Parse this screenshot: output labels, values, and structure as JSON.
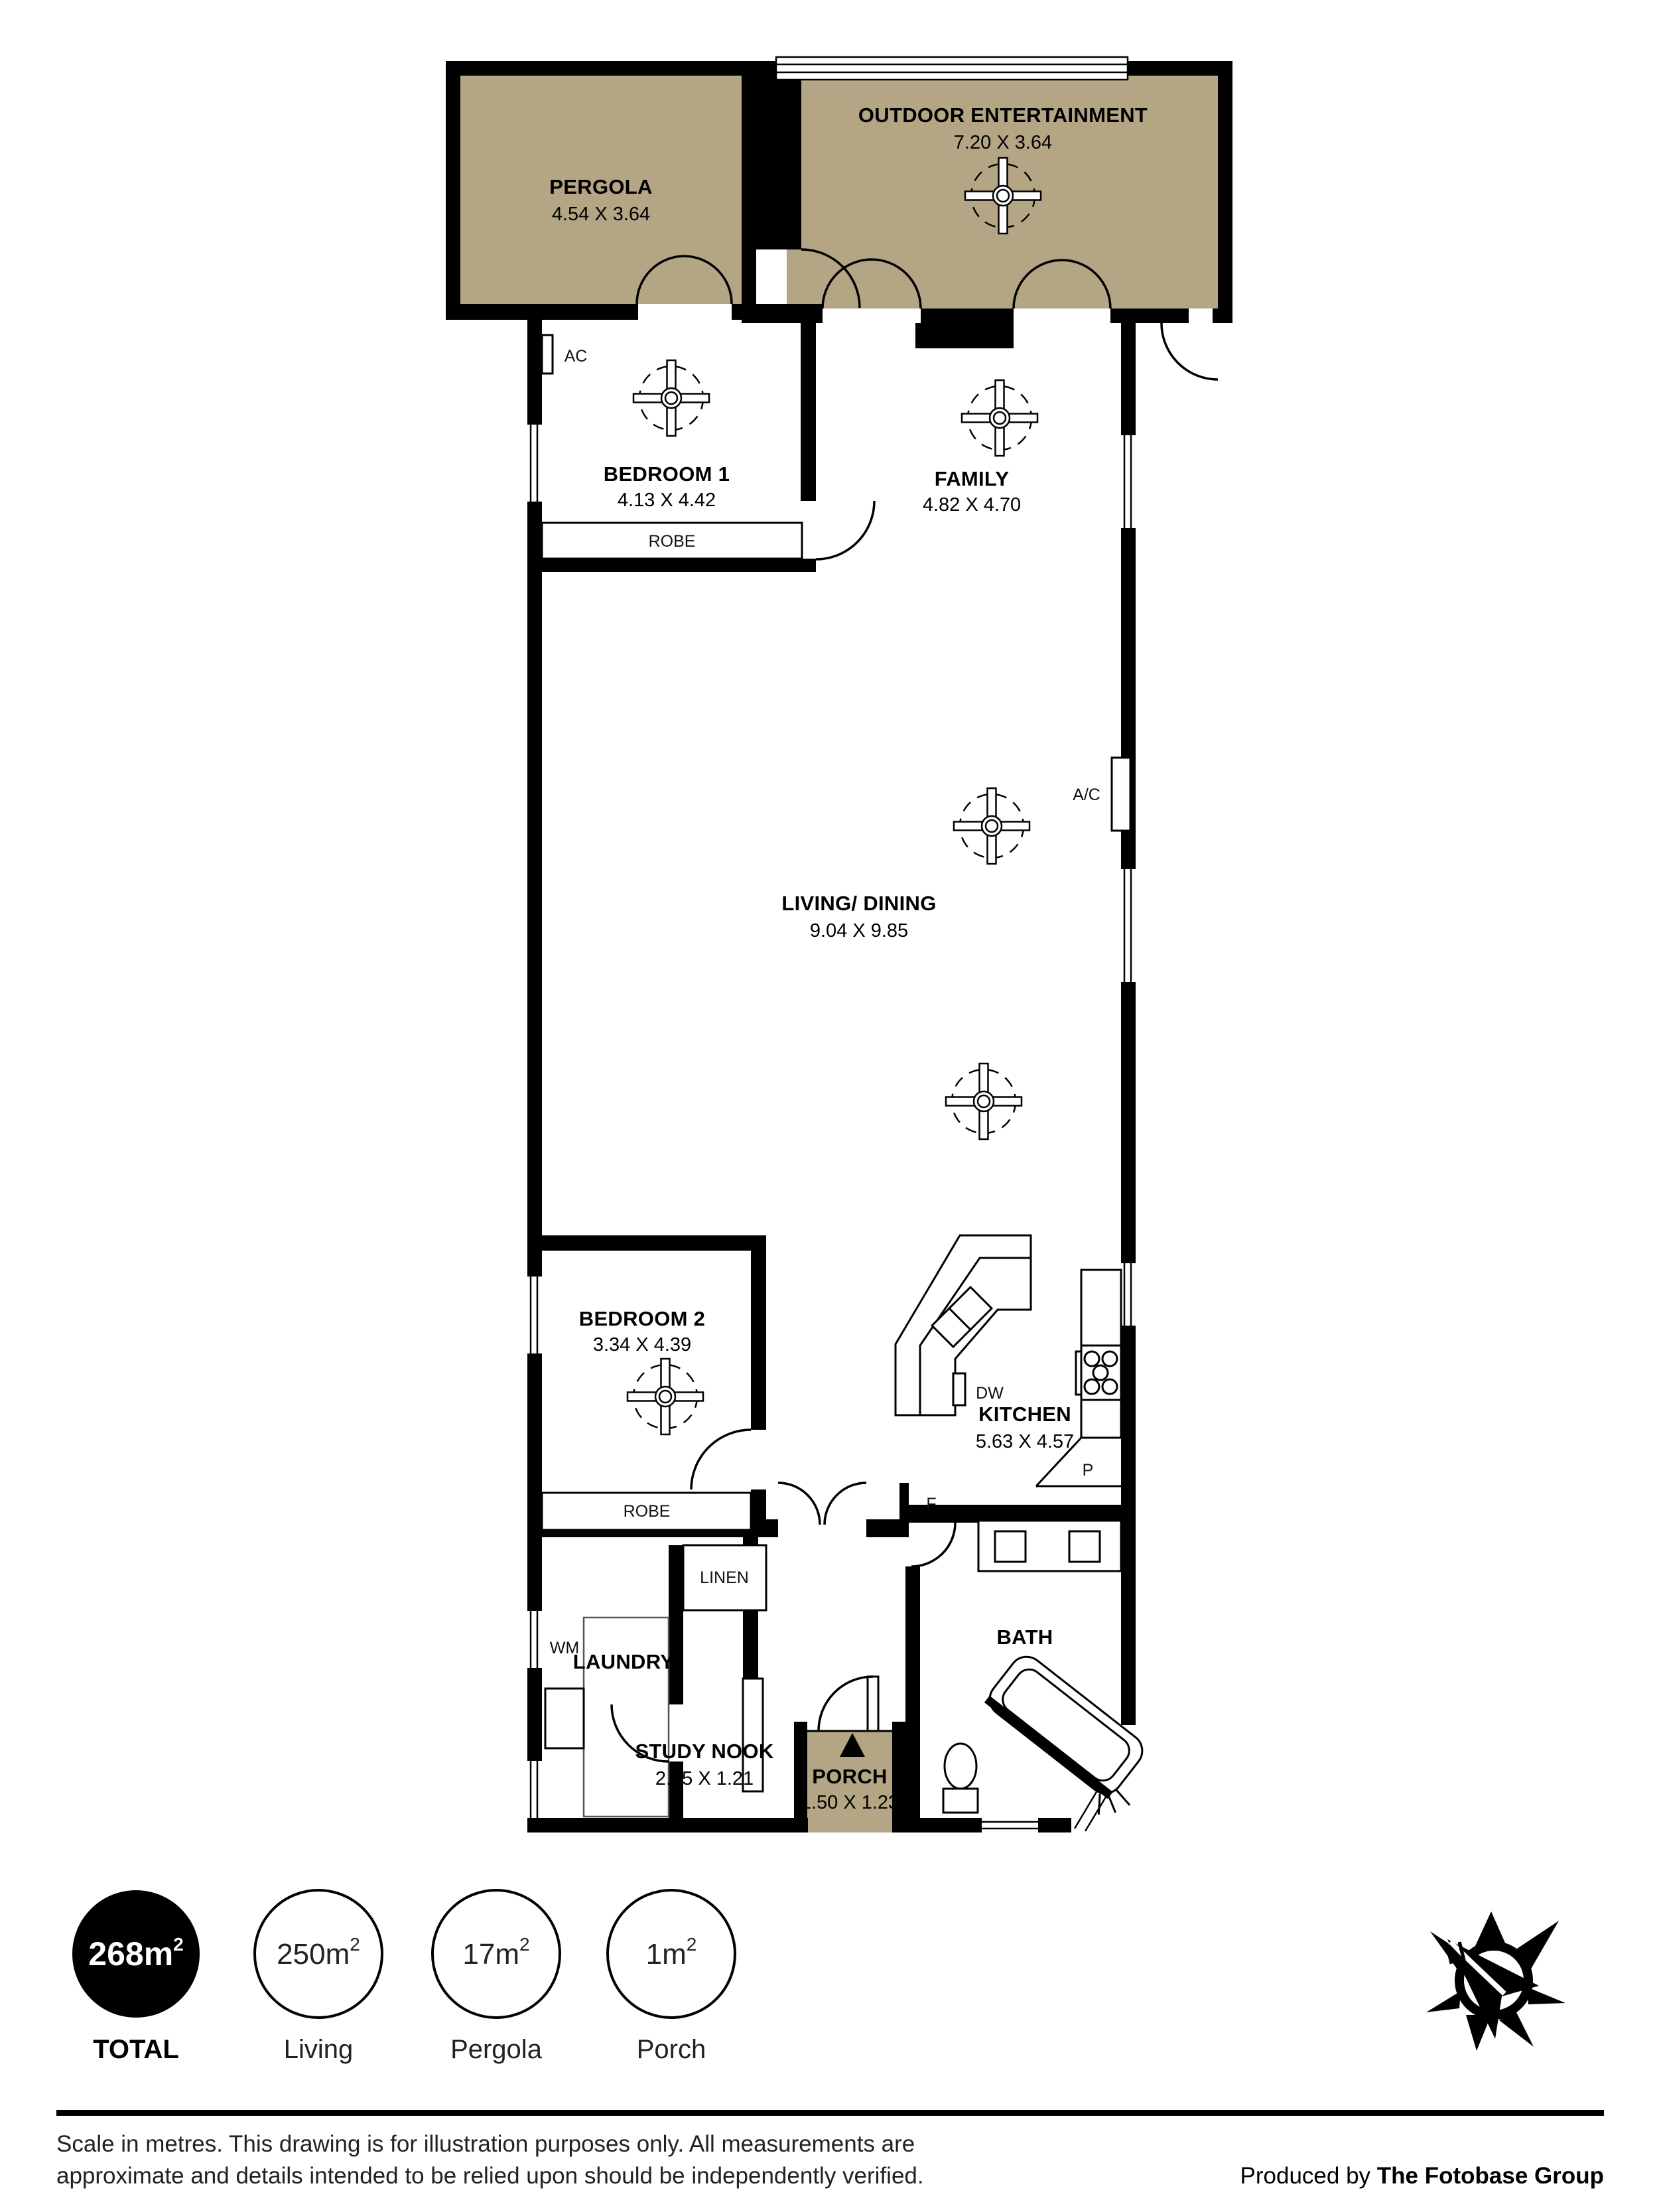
{
  "rooms": {
    "pergola": {
      "name": "PERGOLA",
      "dims": "4.54 X 3.64"
    },
    "outdoor": {
      "name": "OUTDOOR ENTERTAINMENT",
      "dims": "7.20 X 3.64"
    },
    "bedroom1": {
      "name": "BEDROOM 1",
      "dims": "4.13 X 4.42"
    },
    "family": {
      "name": "FAMILY",
      "dims": "4.82 X 4.70"
    },
    "living": {
      "name": "LIVING/ DINING",
      "dims": "9.04 X 9.85"
    },
    "bedroom2": {
      "name": "BEDROOM 2",
      "dims": "3.34 X 4.39"
    },
    "kitchen": {
      "name": "KITCHEN",
      "dims": "5.63 X 4.57"
    },
    "laundry": {
      "name": "LAUNDRY"
    },
    "study": {
      "name": "STUDY NOOK",
      "dims": "2.05 X 1.21"
    },
    "porch": {
      "name": "PORCH",
      "dims": "1.50 X 1.23"
    },
    "bath": {
      "name": "BATH"
    }
  },
  "fixtures": {
    "robe": "ROBE",
    "linen": "LINEN",
    "wm": "WM",
    "ac": "AC",
    "ac2": "A/C",
    "dw": "DW",
    "fridge": "F",
    "pantry": "P"
  },
  "badges": [
    {
      "value": "268m",
      "sup": "2",
      "label": "TOTAL"
    },
    {
      "value": "250m",
      "sup": "2",
      "label": "Living"
    },
    {
      "value": "17m",
      "sup": "2",
      "label": "Pergola"
    },
    {
      "value": "1m",
      "sup": "2",
      "label": "Porch"
    }
  ],
  "compass": {
    "north": "N"
  },
  "footer": {
    "disclaimer_line1": "Scale in metres. This drawing is for illustration purposes only. All measurements are",
    "disclaimer_line2": "approximate and details intended to be relied upon should be independently verified.",
    "produced_by": "Produced by ",
    "producer": "The Fotobase Group"
  },
  "colors": {
    "outdoor_fill": "#b4a684",
    "wall": "#000000"
  }
}
